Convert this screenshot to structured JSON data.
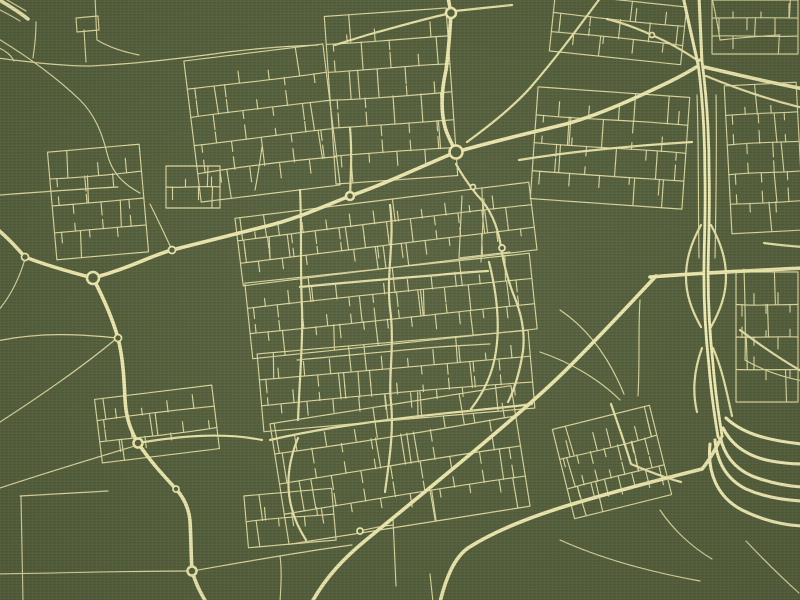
{
  "canvas": {
    "width": 800,
    "height": 600
  },
  "palette": {
    "background": "#545f3c",
    "road_minor": "#d9d49b",
    "road_medium": "#e2dda3",
    "road_major": "#eae5ab",
    "road_motorway": "#efeab2",
    "roundabout_fill": "#545f3c"
  },
  "stroke_widths": {
    "minor": 1.15,
    "medium": 2.2,
    "major": 3.6,
    "motorway": 3.1,
    "motorway_band": 7.0,
    "motorway_band_center": 1.4
  },
  "roads": {
    "motorway_band": [
      "M 700,62 C 705,100 707,140 707,175 C 708,215 706,245 706,275 C 706,308 708,338 711,365 C 713,390 716,412 720,436"
    ],
    "motorway": [
      "M 683,-4 C 688,20 693,42 698,64",
      "M 699,-4 C 700,20 701,42 702,64",
      "M 720,436 C 724,455 734,468 752,476 C 770,483 786,486 802,487",
      "M 715,440 C 717,462 726,479 746,489 C 764,497 783,500 802,501",
      "M 723,428 C 732,446 749,457 771,461 C 782,463 792,464 802,464",
      "M 726,418 C 741,432 763,440 802,444",
      "M 710,444 C 707,472 717,497 742,510 C 764,521 784,525 802,526"
    ],
    "major": [
      "M -4,228 C 8,238 16,247 25,257 C 48,266 70,272 93,278",
      "M 93,278 C 130,268 150,256 172,250 C 204,242 236,234 267,226 C 296,219 322,207 350,196 C 385,184 420,167 456,152",
      "M 456,152 C 451,142 447,135 445,127 C 440,108 442,88 446,70 C 449,48 450,30 451,13 C 450,8 449,3 448,-3",
      "M 456,152 C 494,141 530,133 566,124 C 602,114 640,96 671,81 C 681,76 690,71 698,66",
      "M 700,66 C 730,73 762,81 804,89",
      "M 93,278 C 104,299 112,317 118,338 C 123,358 124,378 125,399 C 126,419 131,431 138,443 C 150,461 163,475 176,489 C 185,499 189,509 190,521 C 191,537 191,555 192,571 C 196,584 200,592 206,602",
      "M 650,277 C 696,273 744,271 804,268",
      "M 656,276 C 628,306 599,337 570,366 C 545,391 519,413 492,436 C 452,470 405,508 366,540 C 344,558 326,577 312,602",
      "M 702,469 C 662,479 620,490 576,503 C 532,516 496,530 468,548 C 454,558 446,578 440,602",
      "M 720,440 C 714,452 708,462 702,469",
      "M -4,-2 C 8,5 18,11 28,19"
    ],
    "medium": [
      "M 601,-3 C 578,28 556,58 530,88 C 512,108 489,126 467,142",
      "M 451,13 C 424,19 400,26 374,33 C 360,37 348,41 335,45",
      "M 455,11 C 474,9 492,7 512,5",
      "M 697,60 C 682,50 668,42 654,36 C 639,29 623,23 607,19",
      "M 706,76 C 740,90 770,100 803,108",
      "M 764,243 C 778,245 790,246 803,247",
      "M 519,160 C 568,152 628,146 692,142",
      "M 456,164 C 464,179 471,187 477,195 C 491,209 498,227 501,247 C 504,267 509,284 516,301 C 522,317 525,334 523,351",
      "M 523,351 C 520,370 516,386 508,402",
      "M 300,190 C 302,230 300,268 302,308 C 303,340 300,372 298,420",
      "M 390,205 C 395,240 386,274 390,308 C 395,344 388,380 391,402 C 394,432 389,462 385,492",
      "M 489,262 C 497,294 500,324 496,351 C 493,372 485,391 471,409",
      "M 300,287 C 340,283 388,279 438,275 C 456,273 472,272 488,271",
      "M 270,440 C 330,426 400,418 458,412 C 488,409 510,407 532,404",
      "M 298,438 C 284,472 284,506 306,540",
      "M 138,443 C 180,436 222,432 262,440",
      "M 701,225 C 690,245 686,261 686,277 C 686,294 691,309 701,327",
      "M 711,225 C 722,245 726,261 726,277 C 726,294 721,309 711,327",
      "M 702,348 C 694,370 692,391 697,412",
      "M 713,348 C 723,371 727,394 732,416",
      "M 611,404 C 618,424 625,444 631,464 C 650,472 666,478 681,482",
      "M 350,128 C 352,150 351,172 350,196",
      "M 740,330 C 760,345 780,359 803,372"
    ],
    "minor": [
      "M -4,8 C 4,12 12,16 20,21",
      "M 2,-3 L 26,11",
      "M 36,22 C 36,34 35,45 33,58",
      "M -3,47 C 6,51 11,55 14,61",
      "M -3,38 C 25,55 55,76 80,100 C 95,115 102,133 107,153 C 112,174 125,185 140,193",
      "M -3,58 C 30,62 60,66 90,66 C 135,64 185,58 228,52 C 260,48 290,46 318,45",
      "M 86,62 L 84,30",
      "M 76,18 L 98,16 L 99,30 L 77,32 Z",
      "M 95,-3 C 96,14 96,27 97,40 C 110,48 124,52 139,55",
      "M 0,195 C 40,192 80,189 118,187",
      "M 150,204 C 160,224 166,237 172,250",
      "M -3,312 C 12,295 20,276 25,259",
      "M -3,341 C 40,332 80,334 117,338",
      "M 117,338 C 85,365 45,393 -3,424",
      "M -3,489 C 45,473 95,458 138,445",
      "M 20,496 L 108,491",
      "M 21,496 L 23,602",
      "M -3,574 C 60,573 130,571 192,571",
      "M 192,571 C 250,561 305,551 352,545",
      "M 255,190 C 258,175 260,161 262,147",
      "M 462,196 L 459,258",
      "M 484,199 L 481,262",
      "M 459,258 C 476,256 494,254 510,252",
      "M 297,360 C 340,356 382,352 426,348 C 450,346 470,345 490,344",
      "M 393,518 L 396,586",
      "M 430,574 L 433,602",
      "M 746,541 C 762,558 780,576 799,593",
      "M 560,540 C 600,558 650,572 700,581",
      "M 660,510 C 672,528 690,546 712,559",
      "M 744,269 C 745,300 746,330 745,360",
      "M 745,360 C 762,370 782,377 803,381",
      "M 697,95 C 699,150 698,205 699,258",
      "M 716,95 C 717,150 716,205 715,258",
      "M 560,310 C 590,330 610,360 624,394",
      "M 640,300 C 638,330 640,362 638,396",
      "M 540,352 C 570,362 600,380 620,400",
      "M 360,531 C 372,528 382,526 393,525",
      "M 712,-3 C 715,12 718,26 720,40",
      "M 720,40 C 740,38 760,36 780,35",
      "M 280,556 C 282,570 281,586 280,602"
    ]
  },
  "roundabouts": [
    {
      "cx": 451,
      "cy": 13,
      "r": 5.0
    },
    {
      "cx": 456,
      "cy": 152,
      "r": 6.5
    },
    {
      "cx": 350,
      "cy": 196,
      "r": 4.0
    },
    {
      "cx": 172,
      "cy": 250,
      "r": 3.5
    },
    {
      "cx": 93,
      "cy": 278,
      "r": 6.0
    },
    {
      "cx": 25,
      "cy": 257,
      "r": 3.5
    },
    {
      "cx": 118,
      "cy": 338,
      "r": 3.5
    },
    {
      "cx": 138,
      "cy": 443,
      "r": 4.5
    },
    {
      "cx": 176,
      "cy": 489,
      "r": 3.0
    },
    {
      "cx": 192,
      "cy": 571,
      "r": 4.5
    },
    {
      "cx": 652,
      "cy": 35,
      "r": 2.5
    },
    {
      "cx": 502,
      "cy": 248,
      "r": 3.0
    },
    {
      "cx": 473,
      "cy": 187,
      "r": 2.5
    },
    {
      "cx": 360,
      "cy": 531,
      "r": 3.0
    }
  ],
  "clusters": [
    {
      "name": "village-west",
      "x": 52,
      "y": 148,
      "w": 92,
      "h": 108,
      "angle": -5,
      "rows": 3,
      "pitch": 14,
      "tooth": 12
    },
    {
      "name": "top-suburb-west",
      "x": 192,
      "y": 52,
      "w": 140,
      "h": 142,
      "angle": -7,
      "rows": 4,
      "pitch": 15,
      "tooth": 13
    },
    {
      "name": "top-suburb-east",
      "x": 330,
      "y": 12,
      "w": 122,
      "h": 168,
      "angle": -4,
      "rows": 5,
      "pitch": 14,
      "tooth": 13
    },
    {
      "name": "ne-blocks",
      "x": 552,
      "y": 0,
      "w": 132,
      "h": 58,
      "angle": 6,
      "rows": 2,
      "pitch": 15,
      "tooth": 11
    },
    {
      "name": "east-grid-north",
      "x": 712,
      "y": 0,
      "w": 86,
      "h": 54,
      "angle": 0,
      "rows": 2,
      "pitch": 14,
      "tooth": 11
    },
    {
      "name": "east-grid-mid",
      "x": 728,
      "y": 84,
      "w": 72,
      "h": 148,
      "angle": -3,
      "rows": 4,
      "pitch": 13,
      "tooth": 11
    },
    {
      "name": "east-grid-south",
      "x": 736,
      "y": 272,
      "w": 62,
      "h": 130,
      "angle": 0,
      "rows": 3,
      "pitch": 12,
      "tooth": 11
    },
    {
      "name": "east-suburb",
      "x": 534,
      "y": 92,
      "w": 152,
      "h": 112,
      "angle": 4,
      "rows": 3,
      "pitch": 15,
      "tooth": 12
    },
    {
      "name": "city-band-north",
      "x": 238,
      "y": 200,
      "w": 296,
      "h": 68,
      "angle": -7,
      "rows": 2,
      "pitch": 12,
      "tooth": 12
    },
    {
      "name": "city-band-mid",
      "x": 248,
      "y": 268,
      "w": 286,
      "h": 76,
      "angle": -6,
      "rows": 2,
      "pitch": 12,
      "tooth": 12
    },
    {
      "name": "city-band-south",
      "x": 260,
      "y": 342,
      "w": 272,
      "h": 78,
      "angle": -5,
      "rows": 2,
      "pitch": 13,
      "tooth": 12
    },
    {
      "name": "south-suburb",
      "x": 278,
      "y": 404,
      "w": 244,
      "h": 122,
      "angle": -9,
      "rows": 3,
      "pitch": 15,
      "tooth": 13
    },
    {
      "name": "village-southwest",
      "x": 98,
      "y": 392,
      "w": 118,
      "h": 64,
      "angle": -7,
      "rows": 2,
      "pitch": 13,
      "tooth": 11
    },
    {
      "name": "industrial-estate",
      "x": 562,
      "y": 416,
      "w": 100,
      "h": 92,
      "angle": -14,
      "rows": 2,
      "pitch": 7,
      "tooth": 15
    },
    {
      "name": "hamlet-south",
      "x": 246,
      "y": 492,
      "w": 88,
      "h": 52,
      "angle": -5,
      "rows": 1,
      "pitch": 13,
      "tooth": 10
    },
    {
      "name": "mid-left-blocks",
      "x": 166,
      "y": 166,
      "w": 54,
      "h": 42,
      "angle": 0,
      "rows": 1,
      "pitch": 13,
      "tooth": 10
    }
  ]
}
